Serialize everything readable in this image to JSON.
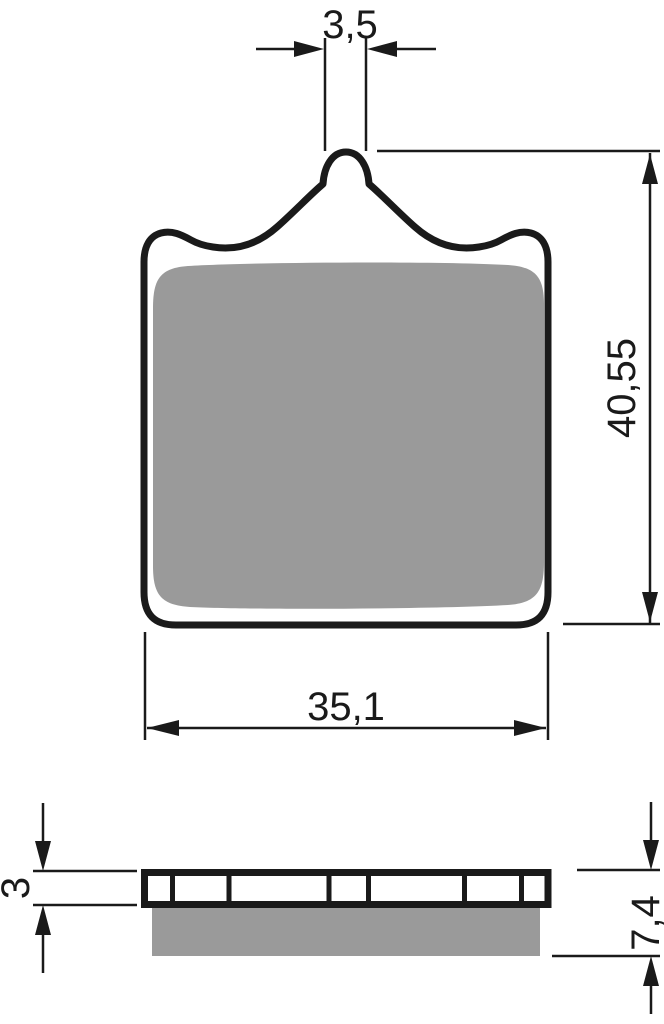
{
  "diagram": {
    "subject": "brake-pad-technical-drawing",
    "front_view": {
      "tab_width_label": "3,5",
      "height_label": "40,55",
      "width_label": "35,1"
    },
    "side_view": {
      "backing_plate_thickness_label": "3",
      "total_thickness_label": "7,4"
    },
    "colors": {
      "line": "#1a1a1a",
      "friction_material": "#9a9a9a",
      "background": "#ffffff"
    }
  }
}
